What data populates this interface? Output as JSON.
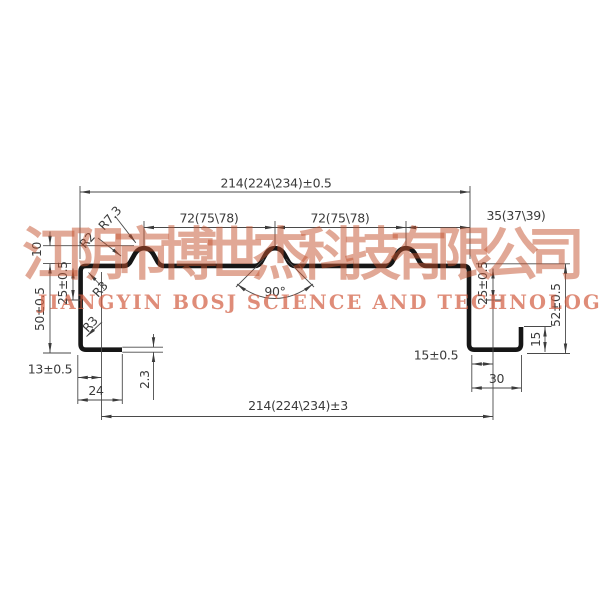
{
  "drawing": {
    "dimensions": {
      "overall_width_top": "214(224\\234)±0.5",
      "pitch_left": "72(75\\78)",
      "pitch_right": "72(75\\78)",
      "right_end_width": "35(37\\39)",
      "rib_height": "10",
      "left_height": "50±0.5",
      "left_offset": "25±0.5",
      "right_offset": "25±0.5",
      "right_height": "52±0.5",
      "right_lip_height": "15",
      "right_foot_inner": "15±0.5",
      "right_foot_width": "30",
      "overall_width_bottom": "214(224\\234)±3",
      "left_foot_width": "13±0.5",
      "left_foot_outer": "24",
      "thickness": "2.3",
      "rib_angle": "90°",
      "radius_crest": "R7.3",
      "radius_base": "R2",
      "radius_corner_top": "R3",
      "radius_corner_bottom": "R3"
    },
    "watermark": {
      "company_cn": "江阴市博世杰科技有限公司",
      "company_en": "JIANGYIN BOSJ SCIENCE AND TECHNOLOGY CO.,LTD"
    },
    "colors": {
      "profile": "#161616",
      "dimension_line": "#4a4a4a",
      "dimension_text": "#3b3b3b",
      "watermark": "#c65a2e",
      "background": "#ffffff"
    }
  }
}
